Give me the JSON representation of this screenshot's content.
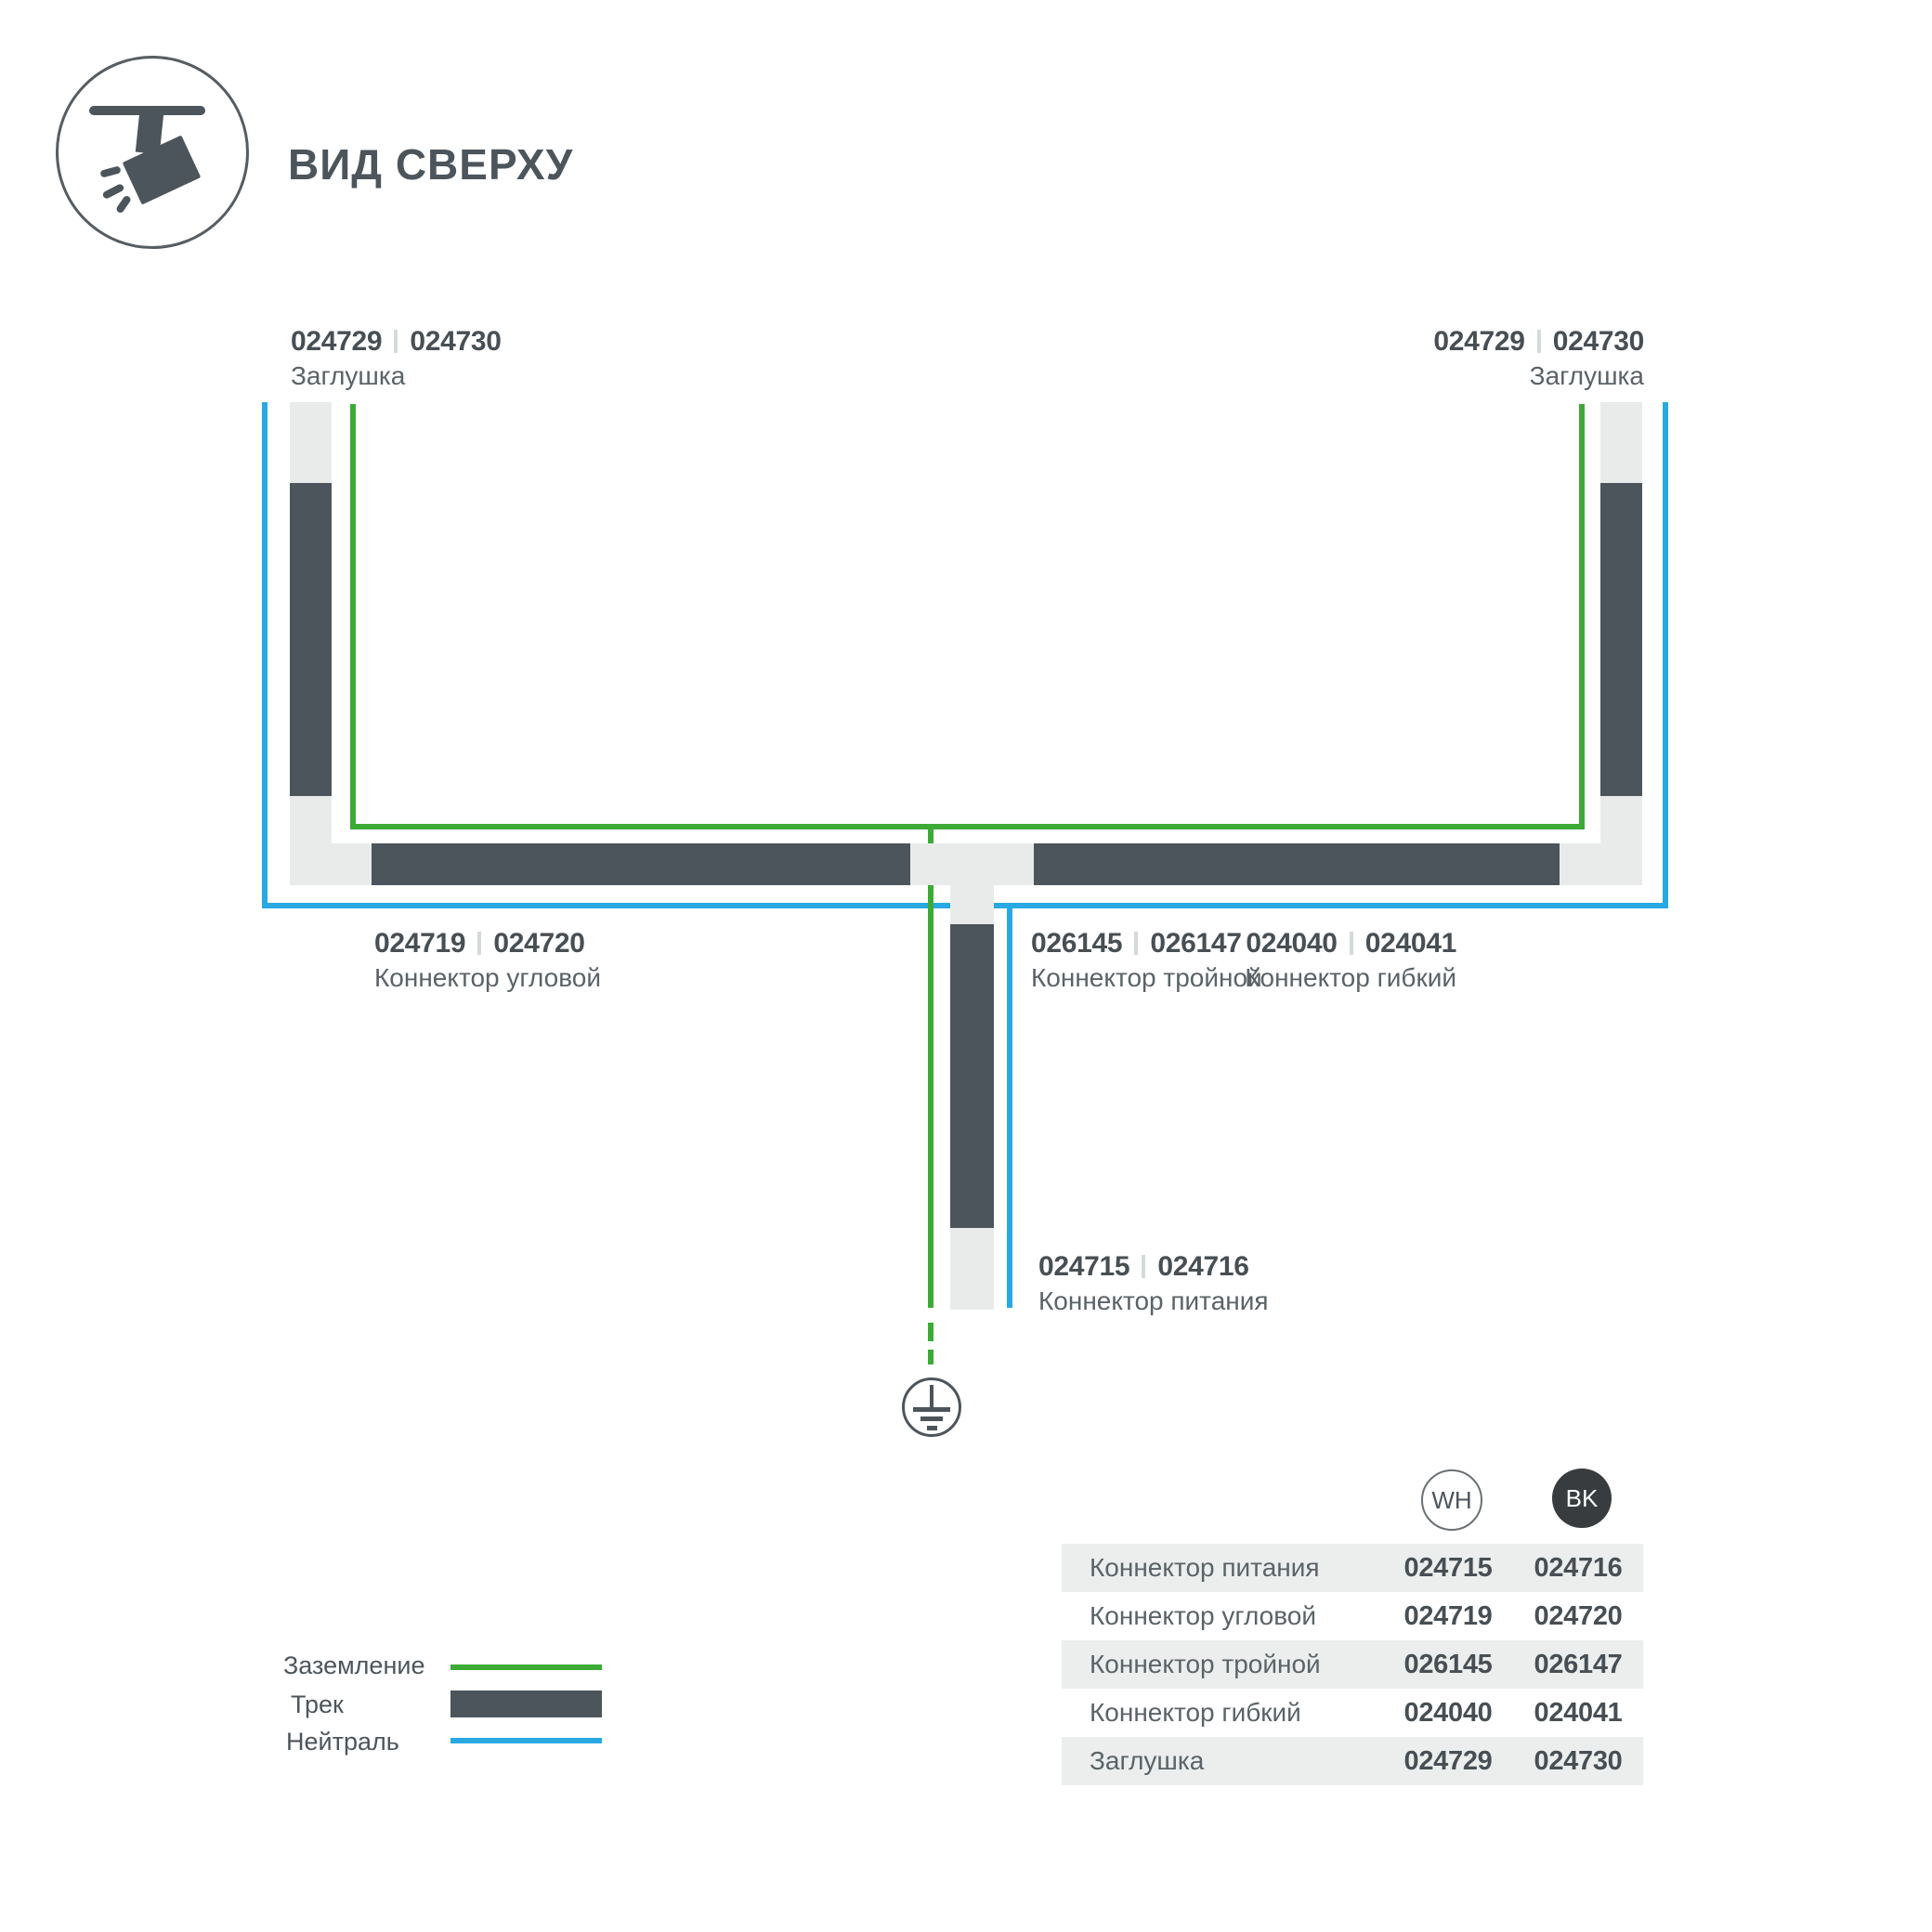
{
  "header": {
    "title": "ВИД СВЕРХУ",
    "icon": "track-spotlight-icon"
  },
  "colors": {
    "track": "#4C555B",
    "ground_green": "#3BAA36",
    "neutral_blue": "#29A9E1",
    "connector_gray": "#E9EBEB",
    "table_row_alt": "#ECEEEE",
    "bk_badge": "#383C3E"
  },
  "diagram": {
    "endcap_left": {
      "code_wh": "024729",
      "code_bk": "024730",
      "name": "Заглушка"
    },
    "endcap_right": {
      "code_wh": "024729",
      "code_bk": "024730",
      "name": "Заглушка"
    },
    "corner_connector": {
      "code_wh": "024719",
      "code_bk": "024720",
      "name": "Коннектор угловой"
    },
    "triple_connector": {
      "code_wh": "026145",
      "code_bk": "026147",
      "name": "Коннектор тройной"
    },
    "flex_connector": {
      "code_wh": "024040",
      "code_bk": "024041",
      "name": "Коннектор гибкий"
    },
    "power_connector": {
      "code_wh": "024715",
      "code_bk": "024716",
      "name": "Коннектор питания"
    }
  },
  "legend": {
    "ground": "Заземление",
    "track": "Трек",
    "neutral": "Нейтраль"
  },
  "table": {
    "col_wh": "WH",
    "col_bk": "BK",
    "rows": [
      {
        "label": "Коннектор питания",
        "wh": "024715",
        "bk": "024716"
      },
      {
        "label": "Коннектор угловой",
        "wh": "024719",
        "bk": "024720"
      },
      {
        "label": "Коннектор тройной",
        "wh": "026145",
        "bk": "026147"
      },
      {
        "label": "Коннектор гибкий",
        "wh": "024040",
        "bk": "024041"
      },
      {
        "label": "Заглушка",
        "wh": "024729",
        "bk": "024730"
      }
    ]
  }
}
